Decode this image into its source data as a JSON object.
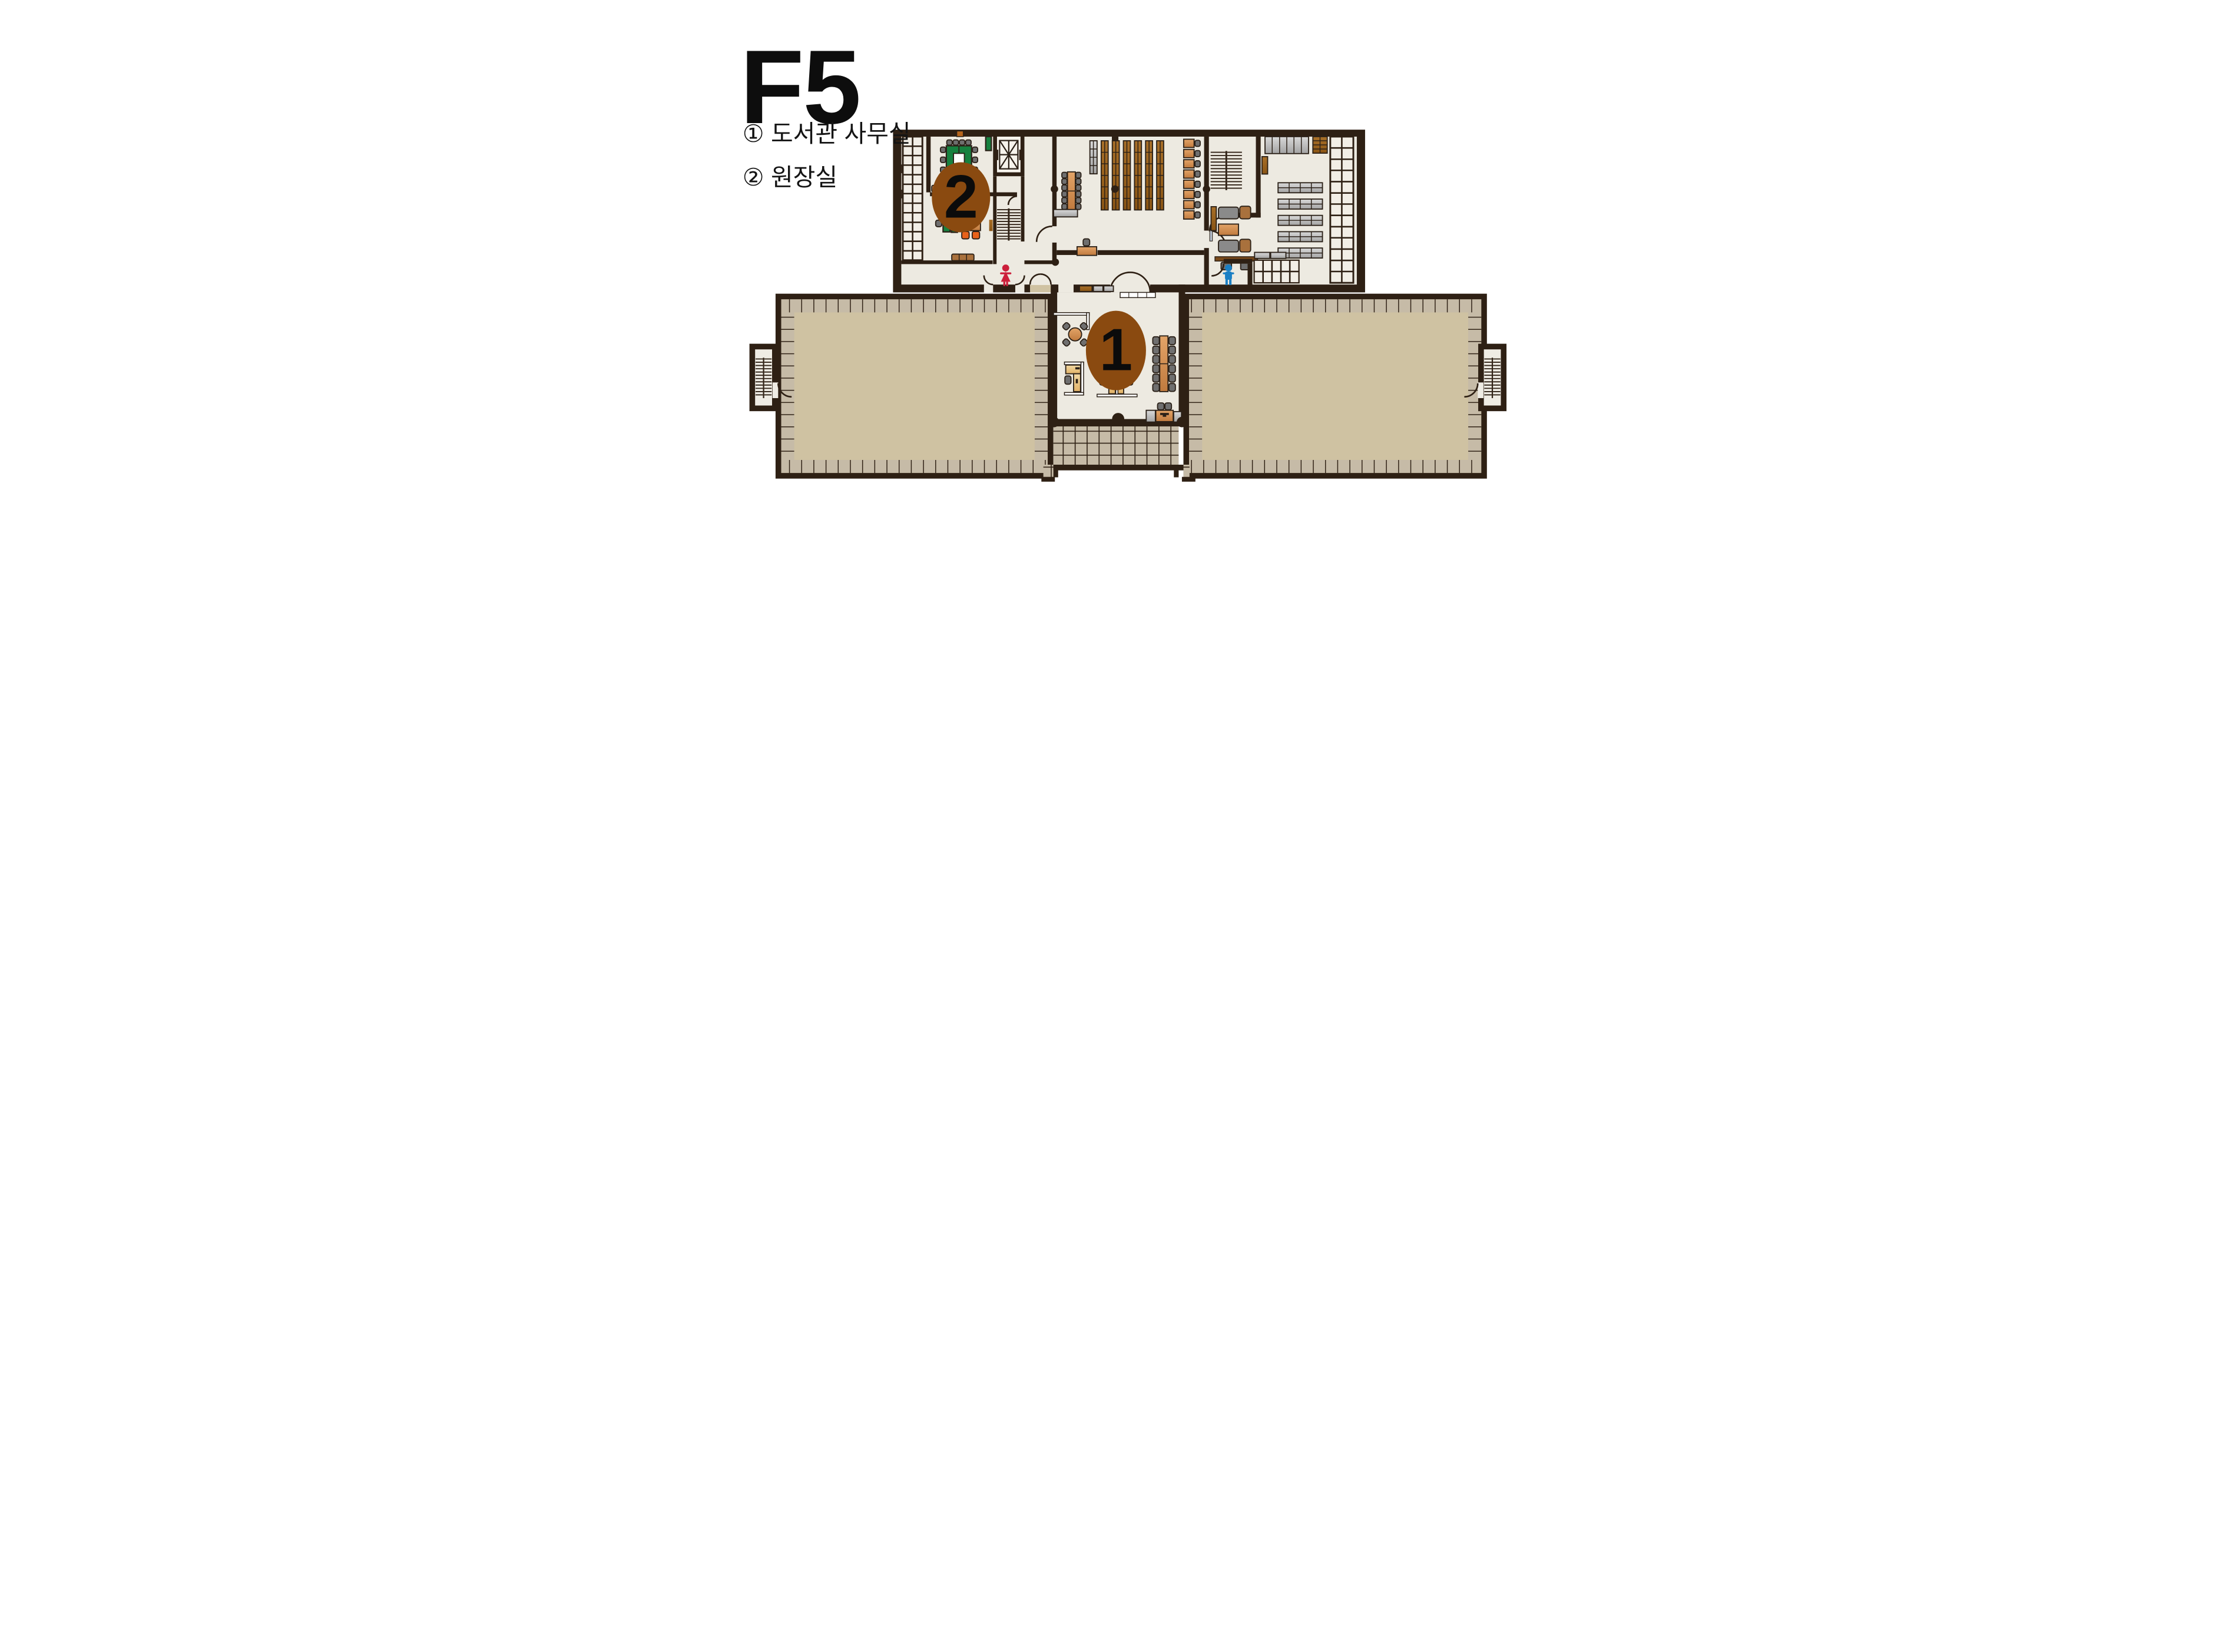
{
  "title": "F5",
  "legend": {
    "items": [
      {
        "label": "① 도서관 사무실"
      },
      {
        "label": "② 원장실"
      }
    ]
  },
  "markers": [
    {
      "number": "1",
      "name": "도서관 사무실"
    },
    {
      "number": "2",
      "name": "원장실"
    }
  ],
  "icons": [
    "woman-icon",
    "man-icon",
    "elevator-icon",
    "stairs-icon",
    "bookshelf-icon",
    "conference-table-icon",
    "sofa-icon",
    "desk-icon"
  ],
  "colors": {
    "wall": "#2e2014",
    "floor": "#edeae1",
    "tile": "#c6bba7",
    "terrace": "#cfc2a2",
    "marker_circle": "#8a4a10",
    "conference_table_green": "#17813f",
    "wood_orange": "#d08a4b",
    "bookshelf_brown": "#96601c",
    "chair_gray": "#6f6f6f",
    "woman_figure_red": "#cc1f3a",
    "man_figure_blue": "#1b7fc4"
  }
}
